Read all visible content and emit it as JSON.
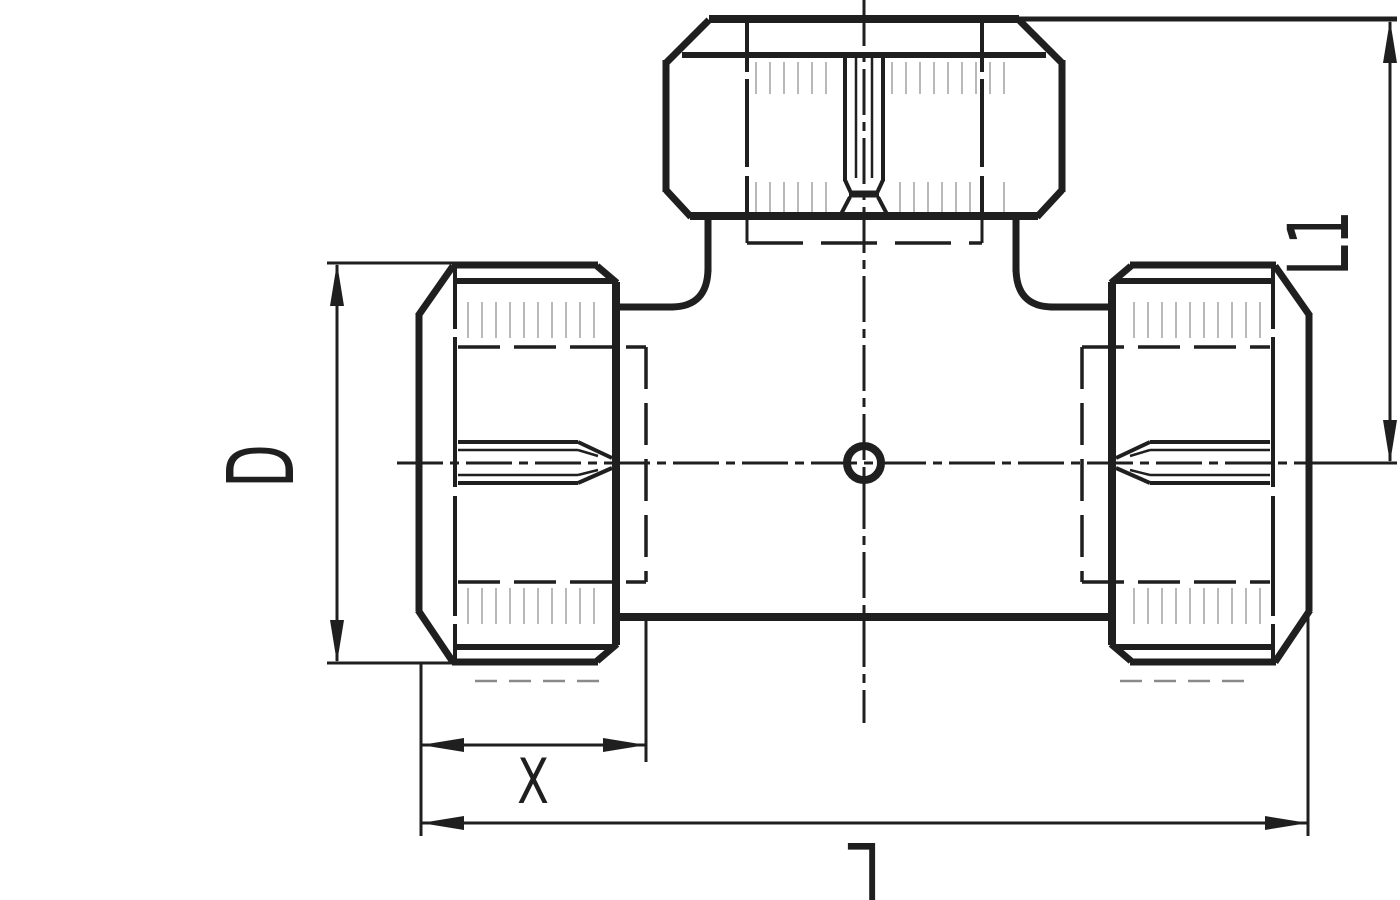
{
  "drawing": {
    "type": "technical-line-drawing",
    "subject": "compression tee fitting, side elevation with dimensions",
    "background_color": "#ffffff",
    "line_color": "#1f1f1f",
    "faint_line_color": "#b9b9b9",
    "dimension_labels": {
      "diameter": "D",
      "nut_width": "X",
      "branch_height": "L1",
      "overall_length": "L"
    }
  }
}
